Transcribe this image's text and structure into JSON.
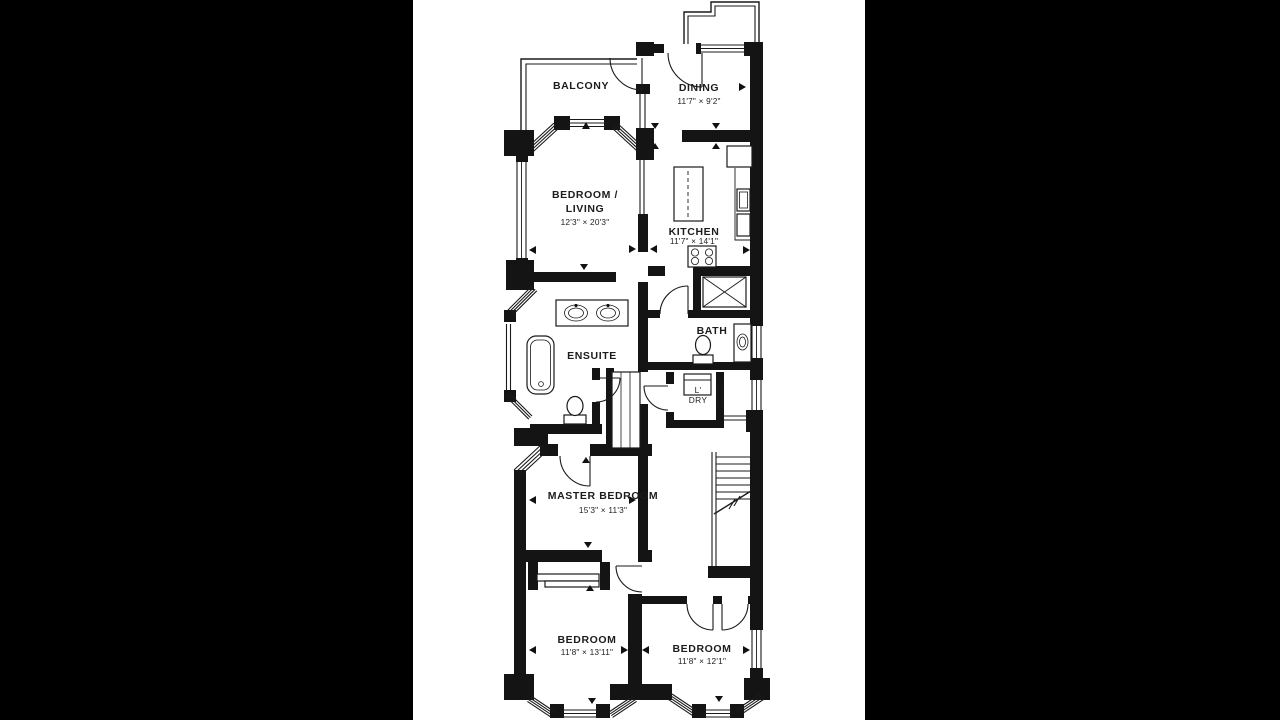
{
  "canvas": {
    "background": "#000000",
    "paper": "#ffffff",
    "line_color": "#1a1a1a"
  },
  "rooms": {
    "balcony": {
      "name": "BALCONY"
    },
    "dining": {
      "name": "DINING",
      "dims": "11'7\" × 9'2\""
    },
    "bedroom_living": {
      "name_line1": "BEDROOM /",
      "name_line2": "LIVING",
      "dims": "12'3\" × 20'3\""
    },
    "kitchen": {
      "name": "KITCHEN",
      "dims": "11'7\" × 14'1\""
    },
    "ensuite": {
      "name": "ENSUITE"
    },
    "bath": {
      "name": "BATH"
    },
    "laundry": {
      "name_line1": "L'",
      "name_line2": "DRY"
    },
    "master_bedroom": {
      "name": "MASTER BEDROOM",
      "dims": "15'3\" × 11'3\""
    },
    "bedroom_left": {
      "name": "BEDROOM",
      "dims": "11'8\" × 13'11\""
    },
    "bedroom_right": {
      "name": "BEDROOM",
      "dims": "11'8\" × 12'1\""
    }
  },
  "fixtures": [
    "kitchen-island",
    "refrigerator",
    "kitchen-sink",
    "dishwasher",
    "stove",
    "shower",
    "bath-toilet",
    "bath-vanity-sink",
    "ensuite-double-vanity",
    "bathtub",
    "ensuite-toilet",
    "washer-dryer",
    "staircase",
    "closet-shelving",
    "sliding-closet"
  ]
}
